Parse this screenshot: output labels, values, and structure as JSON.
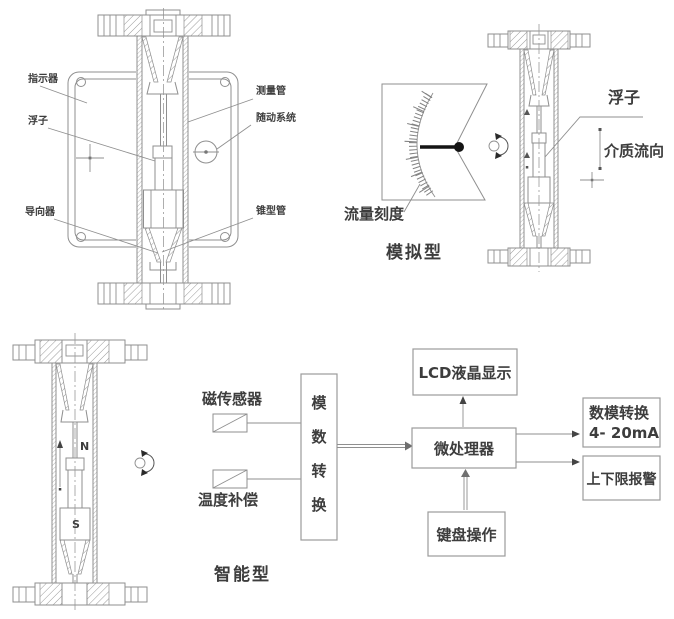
{
  "cross_section": {
    "labels": {
      "indicator": "指示器",
      "float": "浮子",
      "guide": "导向器",
      "measuring_tube": "测量管",
      "follow_up_system": "随动系统",
      "cone_tube": "锥型管"
    }
  },
  "analog": {
    "flow_scale": "流量刻度",
    "type_label": "模拟型",
    "float": "浮子",
    "medium_flow_direction": "介质流向"
  },
  "smart": {
    "type_label": "智能型",
    "pole_n": "N",
    "pole_s": "S",
    "magnetic_sensor": "磁传感器",
    "temperature_compensation": "温度补偿",
    "ad_converter_chars": [
      "模",
      "数",
      "转",
      "换"
    ],
    "lcd_display": "LCD液晶显示",
    "microprocessor": "微处理器",
    "keyboard": "键盘操作",
    "da_converter_line1": "数模转换",
    "da_converter_line2": "4- 20mA",
    "alarm": "上下限报警"
  },
  "colors": {
    "line": "#8f8f8f",
    "text": "#3d3d3d",
    "needle": "#141414",
    "background": "#ffffff"
  }
}
